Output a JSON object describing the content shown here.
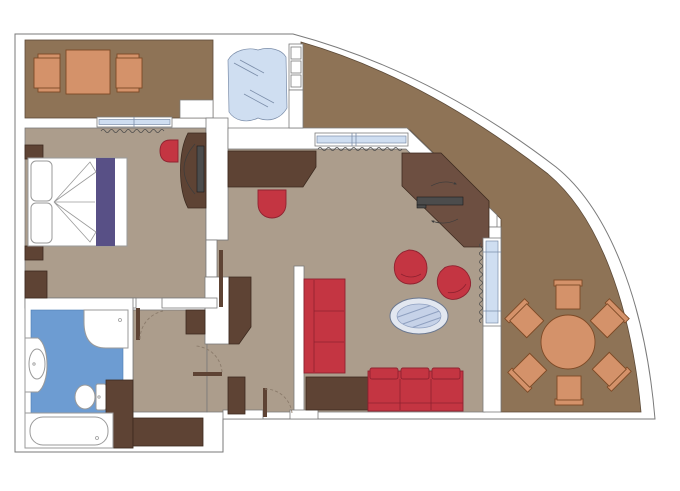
{
  "plan": {
    "type": "hotel-suite-floor-plan",
    "rooms": [
      {
        "name": "top-left-balcony",
        "furniture": [
          "square-table",
          "armchair",
          "armchair"
        ]
      },
      {
        "name": "bedroom",
        "furniture": [
          "double-bed",
          "pillows",
          "bed-runner",
          "nightstand",
          "nightstand",
          "wardrobe",
          "dresser-with-tv",
          "stool"
        ]
      },
      {
        "name": "whirlpool-terrace",
        "furniture": [
          "whirlpool-tub"
        ]
      },
      {
        "name": "living-room",
        "furniture": [
          "sideboard-desk",
          "desk-chair",
          "corner-tv-console",
          "tv",
          "armchair",
          "armchair",
          "oval-glass-coffee-table",
          "three-seat-sofa",
          "three-seat-sofa",
          "corner-side-table"
        ]
      },
      {
        "name": "hallway",
        "furniture": [
          "wardrobe",
          "closet",
          "minibar-cabinet",
          "closet"
        ]
      },
      {
        "name": "bathroom",
        "furniture": [
          "shower",
          "vanity-sink",
          "toilet",
          "bathtub",
          "cabinet"
        ]
      },
      {
        "name": "curved-balcony",
        "furniture": [
          "round-dining-table",
          "chair",
          "chair",
          "chair",
          "chair",
          "chair",
          "chair"
        ]
      }
    ],
    "doors": [
      "bedroom-door",
      "bathroom-door",
      "entry-door",
      "hallway-door-open"
    ],
    "windows": [
      "bedroom-window",
      "living-room-north-window",
      "living-room-east-window",
      "terrace-mullions"
    ],
    "dining_chair_count": 6
  },
  "colors": {
    "wall_line": "#7a7a7a",
    "floor": "#ac9d8c",
    "terrace": "#8e7356",
    "terrace_line": "#5c4a38",
    "wood": "#5e4334",
    "wood2": "#6d4f41",
    "wood_line": "#3c2a1f",
    "red": "#c43542",
    "red_line": "#8f2230",
    "orange": "#d4926a",
    "orange_line": "#7d4a26",
    "bath_floor": "#6d9cd2",
    "bath_floor_line": "#4d7cb2",
    "glass": "#cfdef1",
    "glass_line": "#7b8da9",
    "purple": "#585086",
    "tv": "#4c4c4c",
    "fixture": "#9a9a9a",
    "door_arc": "#8b7b6b"
  }
}
